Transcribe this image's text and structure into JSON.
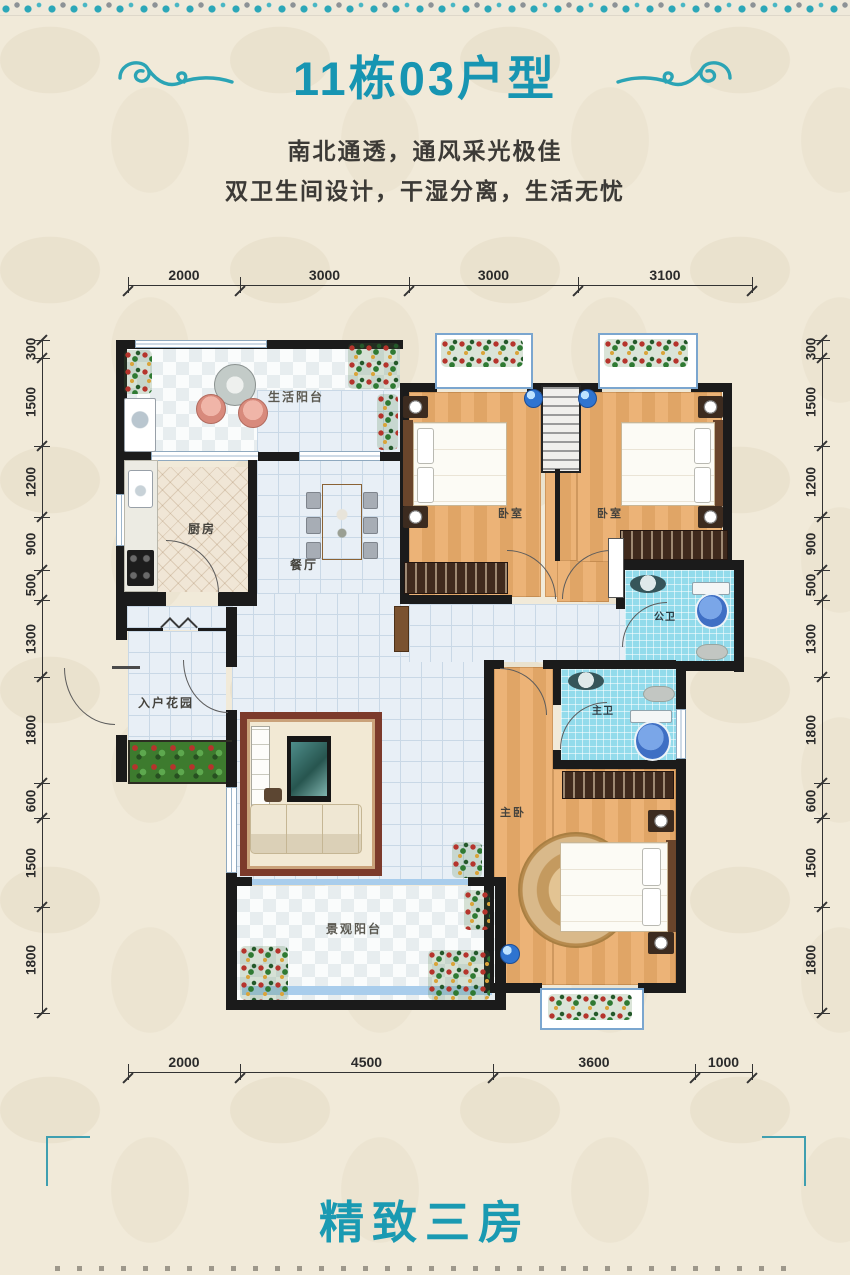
{
  "header": {
    "title": "11栋03户型",
    "subtitle1": "南北通透，通风采光极佳",
    "subtitle2": "双卫生间设计，干湿分离，生活无忧"
  },
  "footer": {
    "title": "精致三房"
  },
  "rooms": {
    "life_balcony": "生活阳台",
    "kitchen": "厨房",
    "dining": "餐厅",
    "bedroom_left": "卧室",
    "bedroom_right": "卧室",
    "public_bath": "公卫",
    "master_bath": "主卫",
    "master_bedroom": "主卧",
    "entry_garden": "入户花园",
    "view_balcony": "景观阳台"
  },
  "dims": {
    "top": [
      "2000",
      "3000",
      "3000",
      "3100"
    ],
    "bottom": [
      "2000",
      "4500",
      "3600",
      "1000"
    ],
    "left": [
      "300",
      "1500",
      "1200",
      "900",
      "500",
      "1300",
      "1800",
      "600",
      "1500",
      "1800"
    ],
    "right": [
      "300",
      "1500",
      "1200",
      "900",
      "500",
      "1300",
      "1800",
      "600",
      "1500",
      "1800"
    ]
  },
  "colors": {
    "accent": "#1a9ab2",
    "wall": "#1b1b1b",
    "wood_floor": "#e4af72",
    "bath_tile": "#92dbeb"
  }
}
